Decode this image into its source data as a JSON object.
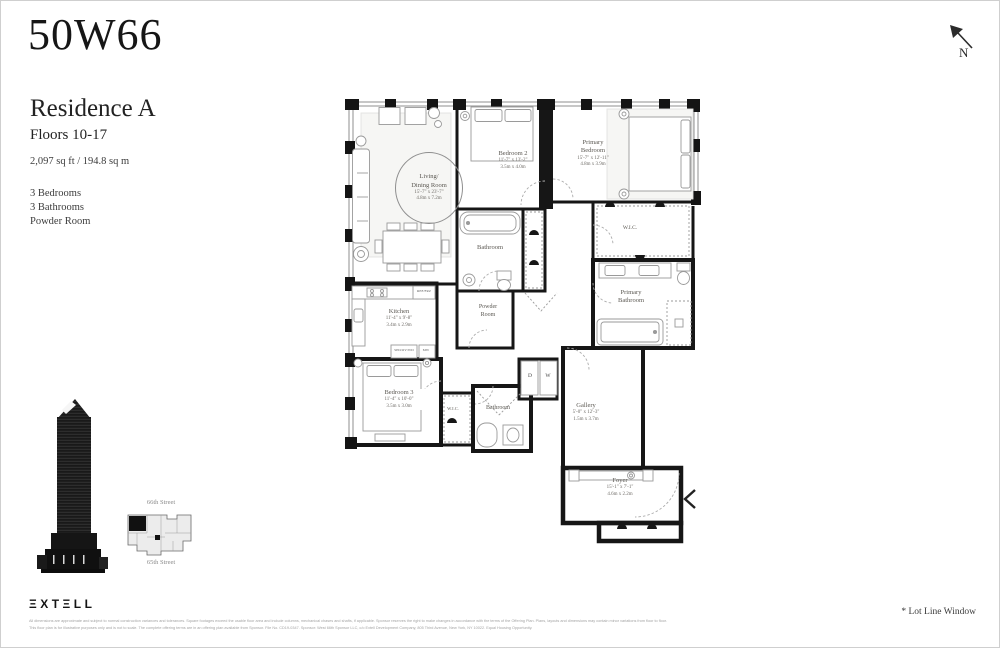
{
  "header": {
    "building_name": "50W66",
    "north_label": "N"
  },
  "residence": {
    "title": "Residence A",
    "floors": "Floors 10-17",
    "area": "2,097 sq ft / 194.8 sq m",
    "features": [
      "3 Bedrooms",
      "3 Bathrooms",
      "Powder Room"
    ]
  },
  "floor_plan": {
    "rooms": {
      "living": {
        "line1": "Living/",
        "line2": "Dining Room",
        "dims_ft": "15'-7\" x 23'-7\"",
        "dims_m": "4.8m x 7.2m"
      },
      "bedroom2": {
        "name": "Bedroom 2",
        "dims_ft": "11'-7\" x 13'-2\"",
        "dims_m": "3.5m x 4.0m"
      },
      "primary_bedroom": {
        "line1": "Primary",
        "line2": "Bedroom",
        "dims_ft": "15'-7\" x 12'-11\"",
        "dims_m": "4.8m x 3.9m"
      },
      "bathroom2": {
        "name": "Bathroom"
      },
      "wic_primary": {
        "name": "W.I.C."
      },
      "primary_bathroom": {
        "line1": "Primary",
        "line2": "Bathroom"
      },
      "kitchen": {
        "name": "Kitchen",
        "dims_ft": "11'-4\" x 9'-8\"",
        "dims_m": "3.4m x 2.9m"
      },
      "powder": {
        "line1": "Powder",
        "line2": "Room"
      },
      "bedroom3": {
        "name": "Bedroom 3",
        "dims_ft": "11'-4\" x 10'-0\"",
        "dims_m": "3.5m x 3.0m"
      },
      "wic3": {
        "name": "W.I.C."
      },
      "bathroom3": {
        "name": "Bathroom"
      },
      "gallery": {
        "name": "Gallery",
        "dims_ft": "5'-0\" x 12'-3\"",
        "dims_m": "1.5m x 3.7m"
      },
      "foyer": {
        "name": "Foyer",
        "dims_ft": "15'-1\" x 7'-1\"",
        "dims_m": "4.6m x 2.2m"
      }
    },
    "appliances": {
      "ref": "REF/FRZ",
      "spd": "SPD/OV/WD",
      "mw": "MW",
      "dryer": "D",
      "washer": "W"
    }
  },
  "key_plan": {
    "street_top": "66th Street",
    "street_bottom": "65th Street"
  },
  "footer": {
    "logo_text": "ΞXTΞLL",
    "disclaimer_line1": "All dimensions are approximate and subject to normal construction variances and tolerances. Square footages exceed the usable floor area and include columns, mechanical chases and shafts, if applicable. Sponsor reserves the right to make changes in accordance with the terms of the Offering Plan. Plans, layouts and dimensions may contain minor variations from floor to floor.",
    "disclaimer_line2": "This floor plan is for illustrative purposes only and is not to scale. The complete offering terms are in an offering plan available from Sponsor. File No. CD19-0347. Sponsor: West 66th Sponsor LLC, c/o Extell Development Company, 805 Third Avenue, New York, NY 10022. Equal Housing Opportunity.",
    "lot_line_note": "* Lot Line Window"
  }
}
